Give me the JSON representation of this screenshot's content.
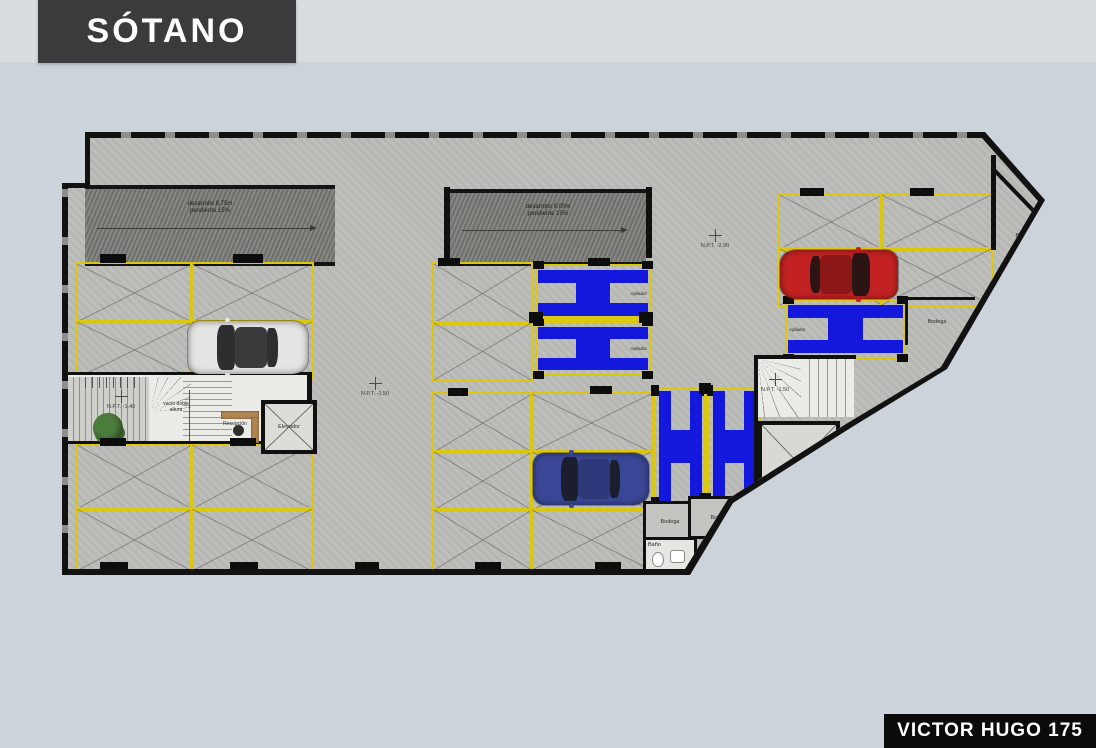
{
  "window": {
    "bg": "#ccd3da"
  },
  "header": {
    "title": "SÓTANO"
  },
  "footer": {
    "project_name": "VICTOR HUGO 175"
  },
  "plan": {
    "ramps": [
      {
        "line1": "desarrollo 8.75m",
        "line2": "pendiente 15%"
      },
      {
        "line1": "desarrollo 8.00m",
        "line2": "pendiente 15%"
      }
    ],
    "labels": {
      "reception": "Recepción",
      "elevator": "Elevador",
      "void": "vacío doble altura",
      "bath": "Baño",
      "stacker": "Apilador"
    },
    "bodegas": [
      "Bodega",
      "Bodega",
      "Bodega",
      "Bodega",
      "Bodega"
    ],
    "levels": {
      "lobby": "N.P.T. -1.40",
      "aisle_center": "N.P.T. -1.50",
      "aisle_right": "N.P.T. -2.90",
      "stairs_right": "N.P.T. -1.50"
    },
    "colors": {
      "lift_blue": "#1418dd",
      "parking_yellow": "#dcc70f",
      "car_white": "#e4e4e2",
      "car_red": "#c32222",
      "car_blue": "#3a4796"
    }
  }
}
